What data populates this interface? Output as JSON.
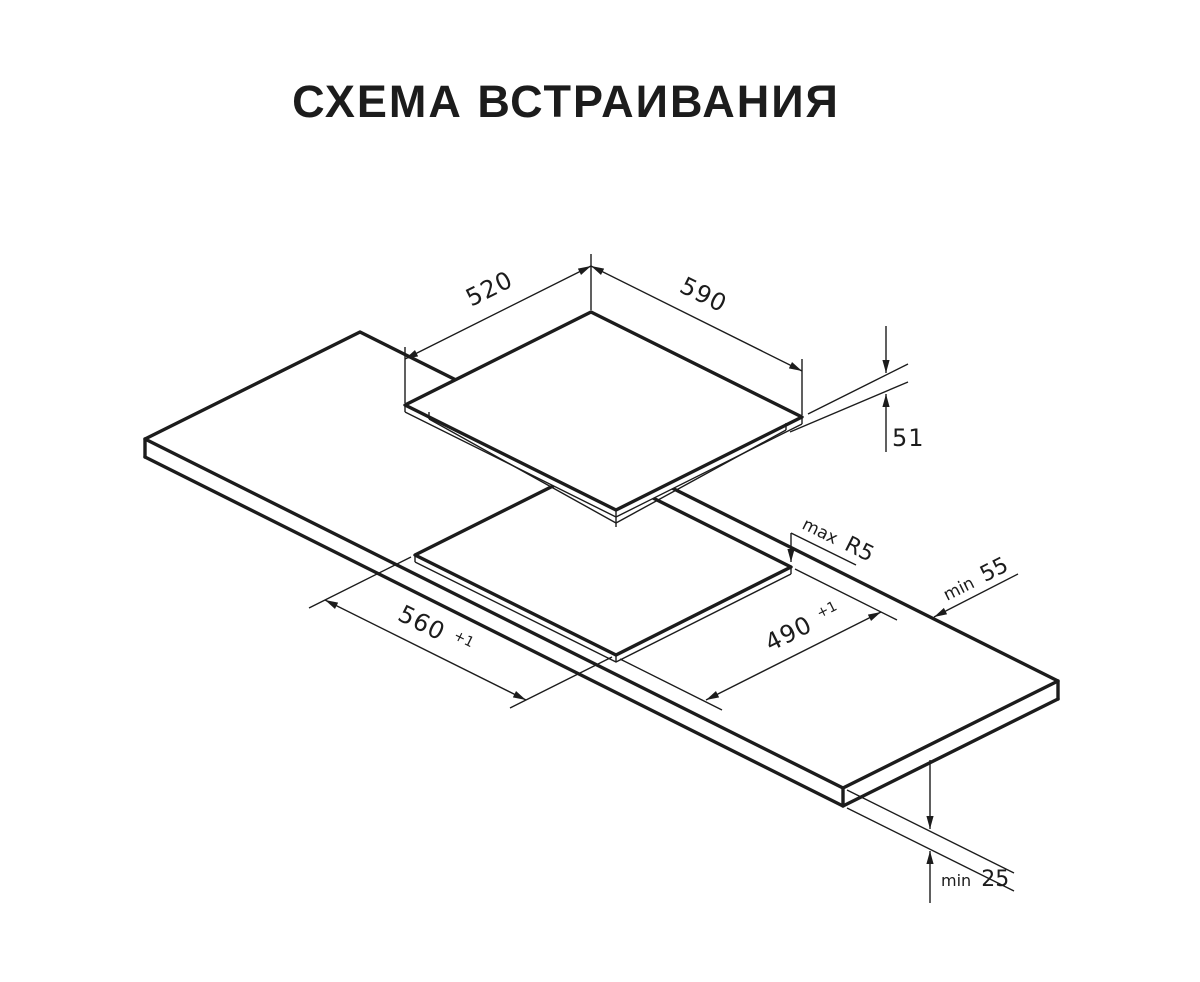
{
  "title": "СХЕМА ВСТРАИВАНИЯ",
  "diagram": {
    "type": "isometric-installation-drawing",
    "hob": {
      "width": "590",
      "depth": "520",
      "height": "51"
    },
    "cutout": {
      "length": "560",
      "length_tolerance": "+1",
      "width": "490",
      "width_tolerance": "+1",
      "corner_radius": {
        "prefix": "max",
        "value": "R5"
      }
    },
    "clearances": {
      "rear_edge": {
        "prefix": "min",
        "value": "55"
      },
      "worktop_thickness": {
        "prefix": "min",
        "value": "25"
      }
    }
  },
  "colors": {
    "background": "#ffffff",
    "line": "#1c1c1c"
  }
}
